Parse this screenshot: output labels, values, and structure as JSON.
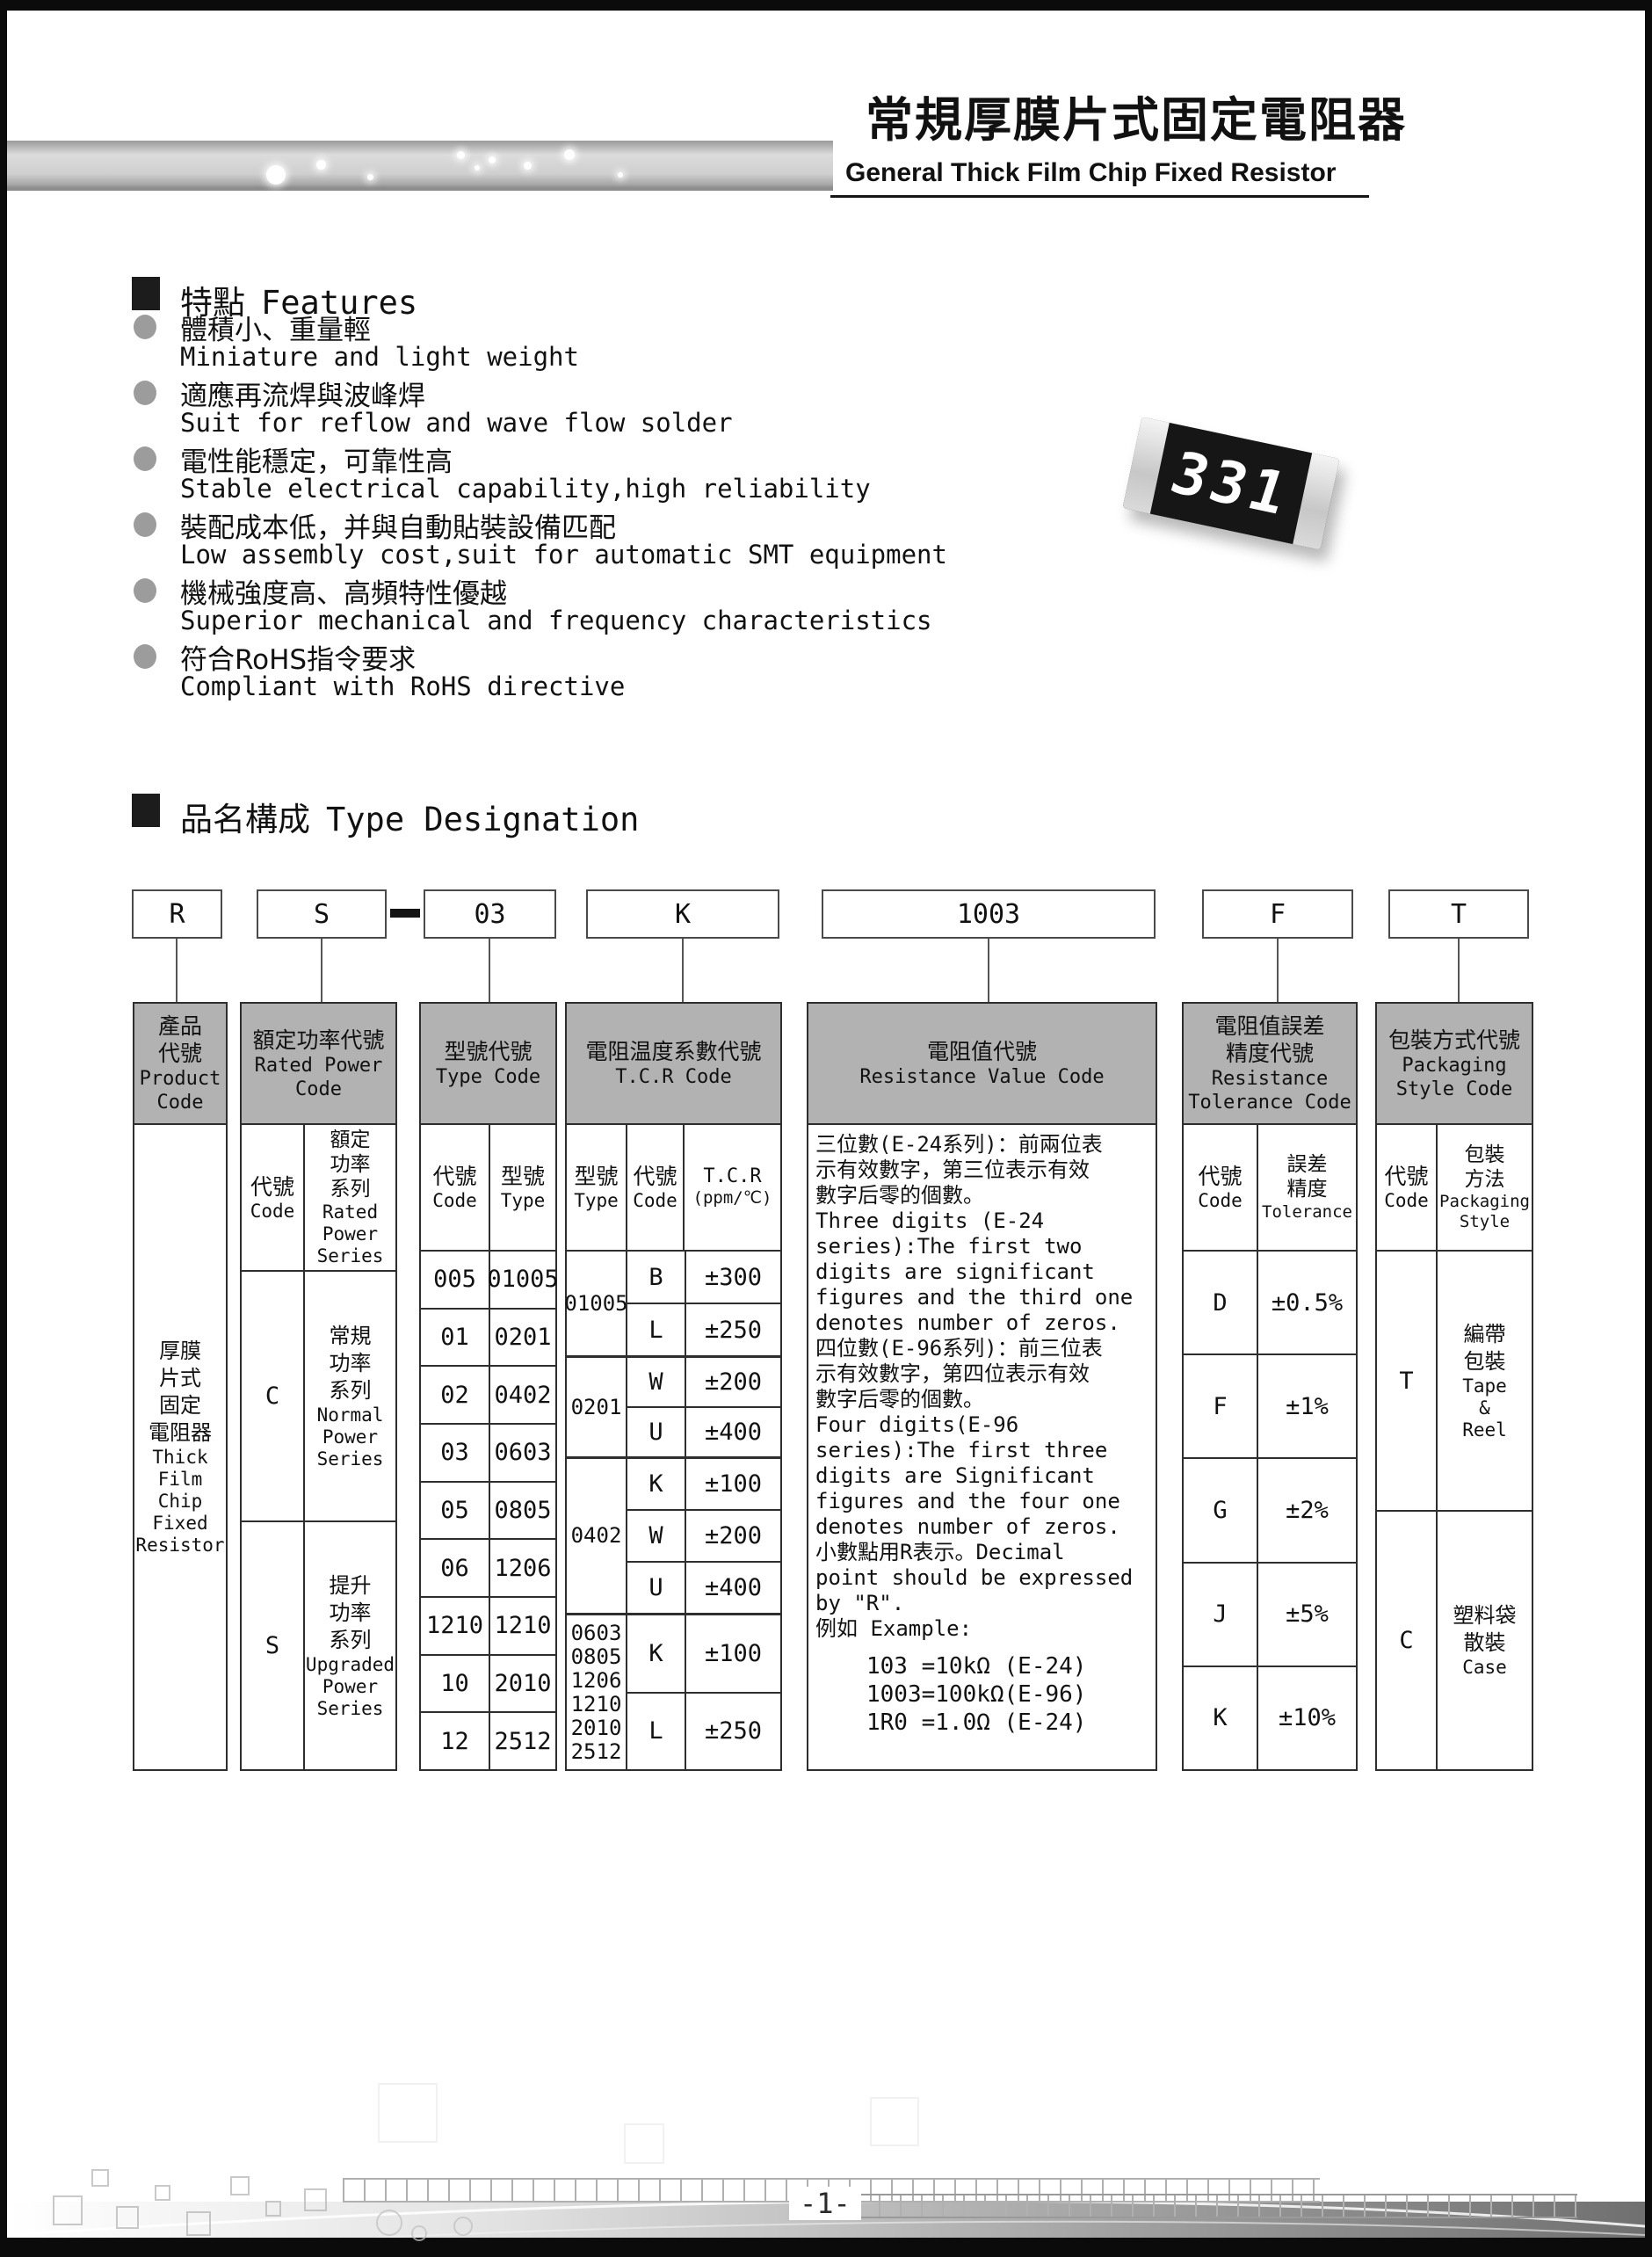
{
  "header": {
    "title_zh": "常規厚膜片式固定電阻器",
    "title_en": "General Thick Film Chip Fixed Resistor"
  },
  "features": {
    "heading_zh": "特點",
    "heading_en": "Features",
    "items": [
      {
        "zh": "體積小、重量輕",
        "en": "Miniature and light weight"
      },
      {
        "zh": "適應再流焊與波峰焊",
        "en": "Suit for reflow and wave flow solder"
      },
      {
        "zh": "電性能穩定，可靠性高",
        "en": "Stable electrical capability,high reliability"
      },
      {
        "zh": "裝配成本低，并與自動貼裝設備匹配",
        "en": "Low assembly cost,suit for automatic SMT equipment"
      },
      {
        "zh": "機械強度高、高頻特性優越",
        "en": "Superior mechanical and frequency characteristics"
      },
      {
        "zh": "符合RoHS指令要求",
        "en": "Compliant with RoHS directive"
      }
    ]
  },
  "resistor_photo": {
    "marking": "331"
  },
  "type_designation": {
    "heading_zh": "品名構成",
    "heading_en": "Type Designation",
    "code_product": "R",
    "code_power": "S",
    "code_type": "03",
    "code_tcr": "K",
    "code_value": "1003",
    "code_tolerance": "F",
    "code_packaging": "T"
  },
  "table": {
    "product": {
      "header_zh": "產品\n代號",
      "header_en": "Product\nCode",
      "body_zh": "厚膜\n片式\n固定\n電阻器",
      "body_en": "Thick\nFilm\nChip\nFixed\nResistor"
    },
    "rated_power": {
      "header_zh": "額定功率代號",
      "header_en": "Rated Power\nCode",
      "sub_code_zh": "代號",
      "sub_code_en": "Code",
      "sub_series_zh": "額定\n功率\n系列",
      "sub_series_en": "Rated\nPower\nSeries",
      "rows": [
        {
          "code": "C",
          "series_zh": "常規\n功率\n系列",
          "series_en": "Normal\nPower\nSeries"
        },
        {
          "code": "S",
          "series_zh": "提升\n功率\n系列",
          "series_en": "Upgraded\nPower\nSeries"
        }
      ]
    },
    "type_code": {
      "header_zh": "型號代號",
      "header_en": "Type Code",
      "sub_code_zh": "代號",
      "sub_code_en": "Code",
      "sub_type_zh": "型號",
      "sub_type_en": "Type",
      "rows": [
        {
          "code": "005",
          "type": "01005"
        },
        {
          "code": "01",
          "type": "0201"
        },
        {
          "code": "02",
          "type": "0402"
        },
        {
          "code": "03",
          "type": "0603"
        },
        {
          "code": "05",
          "type": "0805"
        },
        {
          "code": "06",
          "type": "1206"
        },
        {
          "code": "1210",
          "type": "1210"
        },
        {
          "code": "10",
          "type": "2010"
        },
        {
          "code": "12",
          "type": "2512"
        }
      ]
    },
    "tcr": {
      "header_zh": "電阻温度系數代號",
      "header_en": "T.C.R Code",
      "sub_type_zh": "型號",
      "sub_type_en": "Type",
      "sub_code_zh": "代號",
      "sub_code_en": "Code",
      "sub_value_line1": "T.C.R",
      "sub_value_line2": "(ppm/℃)",
      "groups": [
        {
          "type": "01005",
          "rows": [
            {
              "code": "B",
              "value": "±300"
            },
            {
              "code": "L",
              "value": "±250"
            }
          ]
        },
        {
          "type": "0201",
          "rows": [
            {
              "code": "W",
              "value": "±200"
            },
            {
              "code": "U",
              "value": "±400"
            }
          ]
        },
        {
          "type": "0402",
          "rows": [
            {
              "code": "K",
              "value": "±100"
            },
            {
              "code": "W",
              "value": "±200"
            },
            {
              "code": "U",
              "value": "±400"
            }
          ]
        },
        {
          "type": "0603\n0805\n1206\n1210\n2010\n2512",
          "rows": [
            {
              "code": "K",
              "value": "±100"
            },
            {
              "code": "L",
              "value": "±250"
            }
          ]
        }
      ]
    },
    "resistance_value": {
      "header_zh": "電阻值代號",
      "header_en": "Resistance Value Code",
      "body": "三位數(E-24系列)：前兩位表\n示有效數字，第三位表示有效\n數字后零的個數。\nThree digits (E-24\nseries):The first two\ndigits are significant\nfigures and the third one\ndenotes number of zeros.\n四位數(E-96系列)：前三位表\n示有效數字，第四位表示有效\n數字后零的個數。\nFour digits(E-96\nseries):The first three\ndigits are Significant\nfigures and the four one\ndenotes number of zeros.\n小數點用R表示。Decimal\npoint should be expressed\nby \"R\".\n例如 Example:",
      "examples": "103 =10kΩ (E-24)\n1003=100kΩ(E-96)\n1R0 =1.0Ω (E-24)"
    },
    "tolerance": {
      "header_zh": "電阻值誤差\n精度代號",
      "header_en": "Resistance\nTolerance Code",
      "sub_code_zh": "代號",
      "sub_code_en": "Code",
      "sub_tol_zh": "誤差\n精度",
      "sub_tol_en": "Tolerance",
      "rows": [
        {
          "code": "D",
          "value": "±0.5%"
        },
        {
          "code": "F",
          "value": "±1%"
        },
        {
          "code": "G",
          "value": "±2%"
        },
        {
          "code": "J",
          "value": "±5%"
        },
        {
          "code": "K",
          "value": "±10%"
        }
      ]
    },
    "packaging": {
      "header_zh": "包裝方式代號",
      "header_en": "Packaging\nStyle Code",
      "sub_code_zh": "代號",
      "sub_code_en": "Code",
      "sub_style_zh": "包裝\n方法",
      "sub_style_en": "Packaging\nStyle",
      "rows": [
        {
          "code": "T",
          "style_zh": "編帶\n包裝",
          "style_en": "Tape\n&\nReel"
        },
        {
          "code": "C",
          "style_zh": "塑料袋\n散裝",
          "style_en": "Case"
        }
      ]
    }
  },
  "footer": {
    "page_number": "-1-"
  },
  "colors": {
    "table_header_bg": "#b2b2b2",
    "page_frame": "#0b0b0b",
    "bullet_gray": "#9c9c9c"
  }
}
